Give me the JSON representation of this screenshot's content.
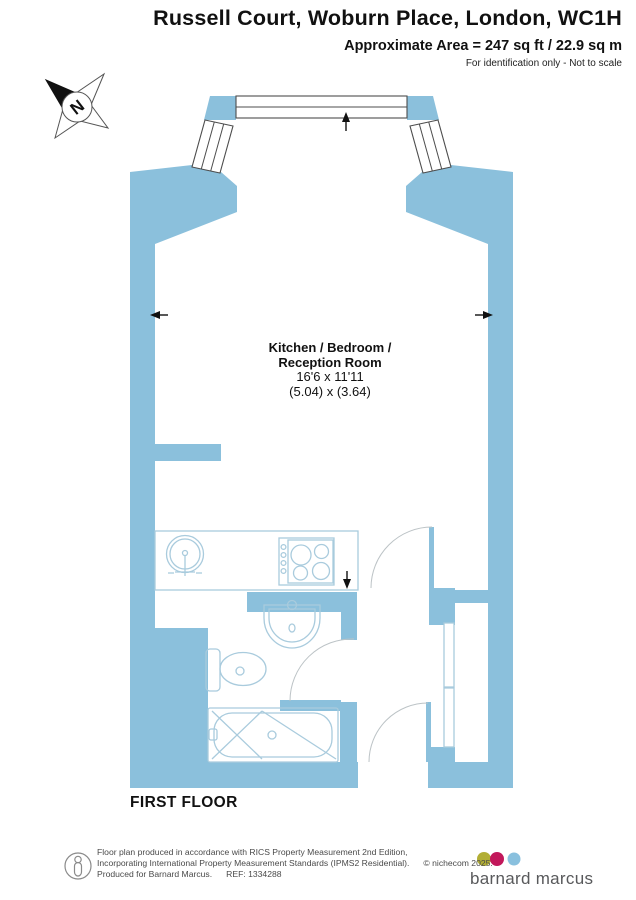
{
  "header": {
    "title": "Russell Court, Woburn Place, London, WC1H",
    "area_line": "Approximate Area = 247 sq ft / 22.9 sq m",
    "disclaimer": "For identification only - Not to scale"
  },
  "plan": {
    "room_label": {
      "line1": "Kitchen / Bedroom /",
      "line2": "Reception Room",
      "dims_imperial": "16'6 x 11'11",
      "dims_metric": "(5.04) x (3.64)"
    },
    "floor_label": "FIRST FLOOR",
    "compass_letter": "N"
  },
  "footer": {
    "line1": "Floor plan produced in accordance with RICS Property Measurement 2nd Edition,",
    "line2": "Incorporating International Property Measurement Standards (IPMS2 Residential).",
    "copyright": "© nichecom 2025.",
    "line3": "Produced for Barnard Marcus.",
    "ref": "REF: 1334288",
    "brand": "barnard marcus"
  },
  "colors": {
    "wall": "#8BC0DC",
    "fixture_outline": "#A9CBDD",
    "door_arc": "#BCC3C6",
    "window_frame": "#4D4D4D",
    "brand_dot_olive": "#B2AE35",
    "brand_dot_magenta": "#C2185B",
    "brand_dot_blue": "#89C0DE",
    "brand_text": "#58595B"
  }
}
